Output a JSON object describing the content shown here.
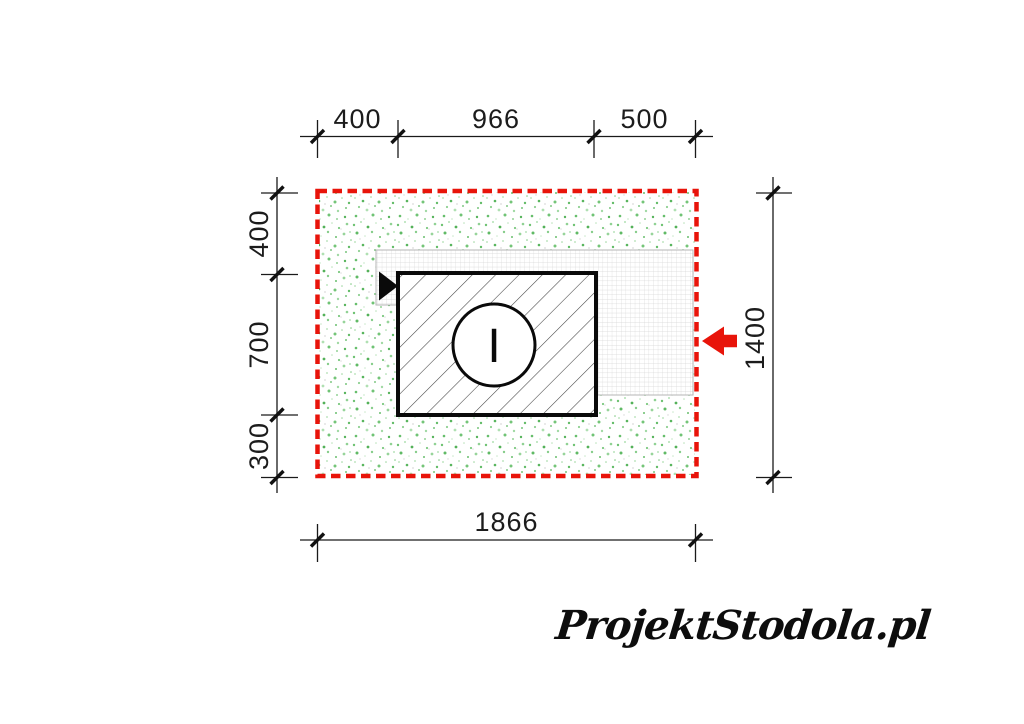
{
  "drawing": {
    "dim_top": {
      "seg1": "400",
      "seg2": "966",
      "seg3": "500"
    },
    "dim_left": {
      "seg1": "400",
      "seg2": "700",
      "seg3": "300"
    },
    "dim_right_total": "1400",
    "dim_bottom_total": "1866",
    "circle_mark": "I",
    "colors": {
      "outline": "#e8140a",
      "arrow": "#e8140a",
      "grid_line": "#d4d4d4",
      "hatch_line": "#3f3f3f",
      "line_black": "#1a1a1a"
    }
  },
  "footer": {
    "logo": "ProjektStodola.pl"
  }
}
